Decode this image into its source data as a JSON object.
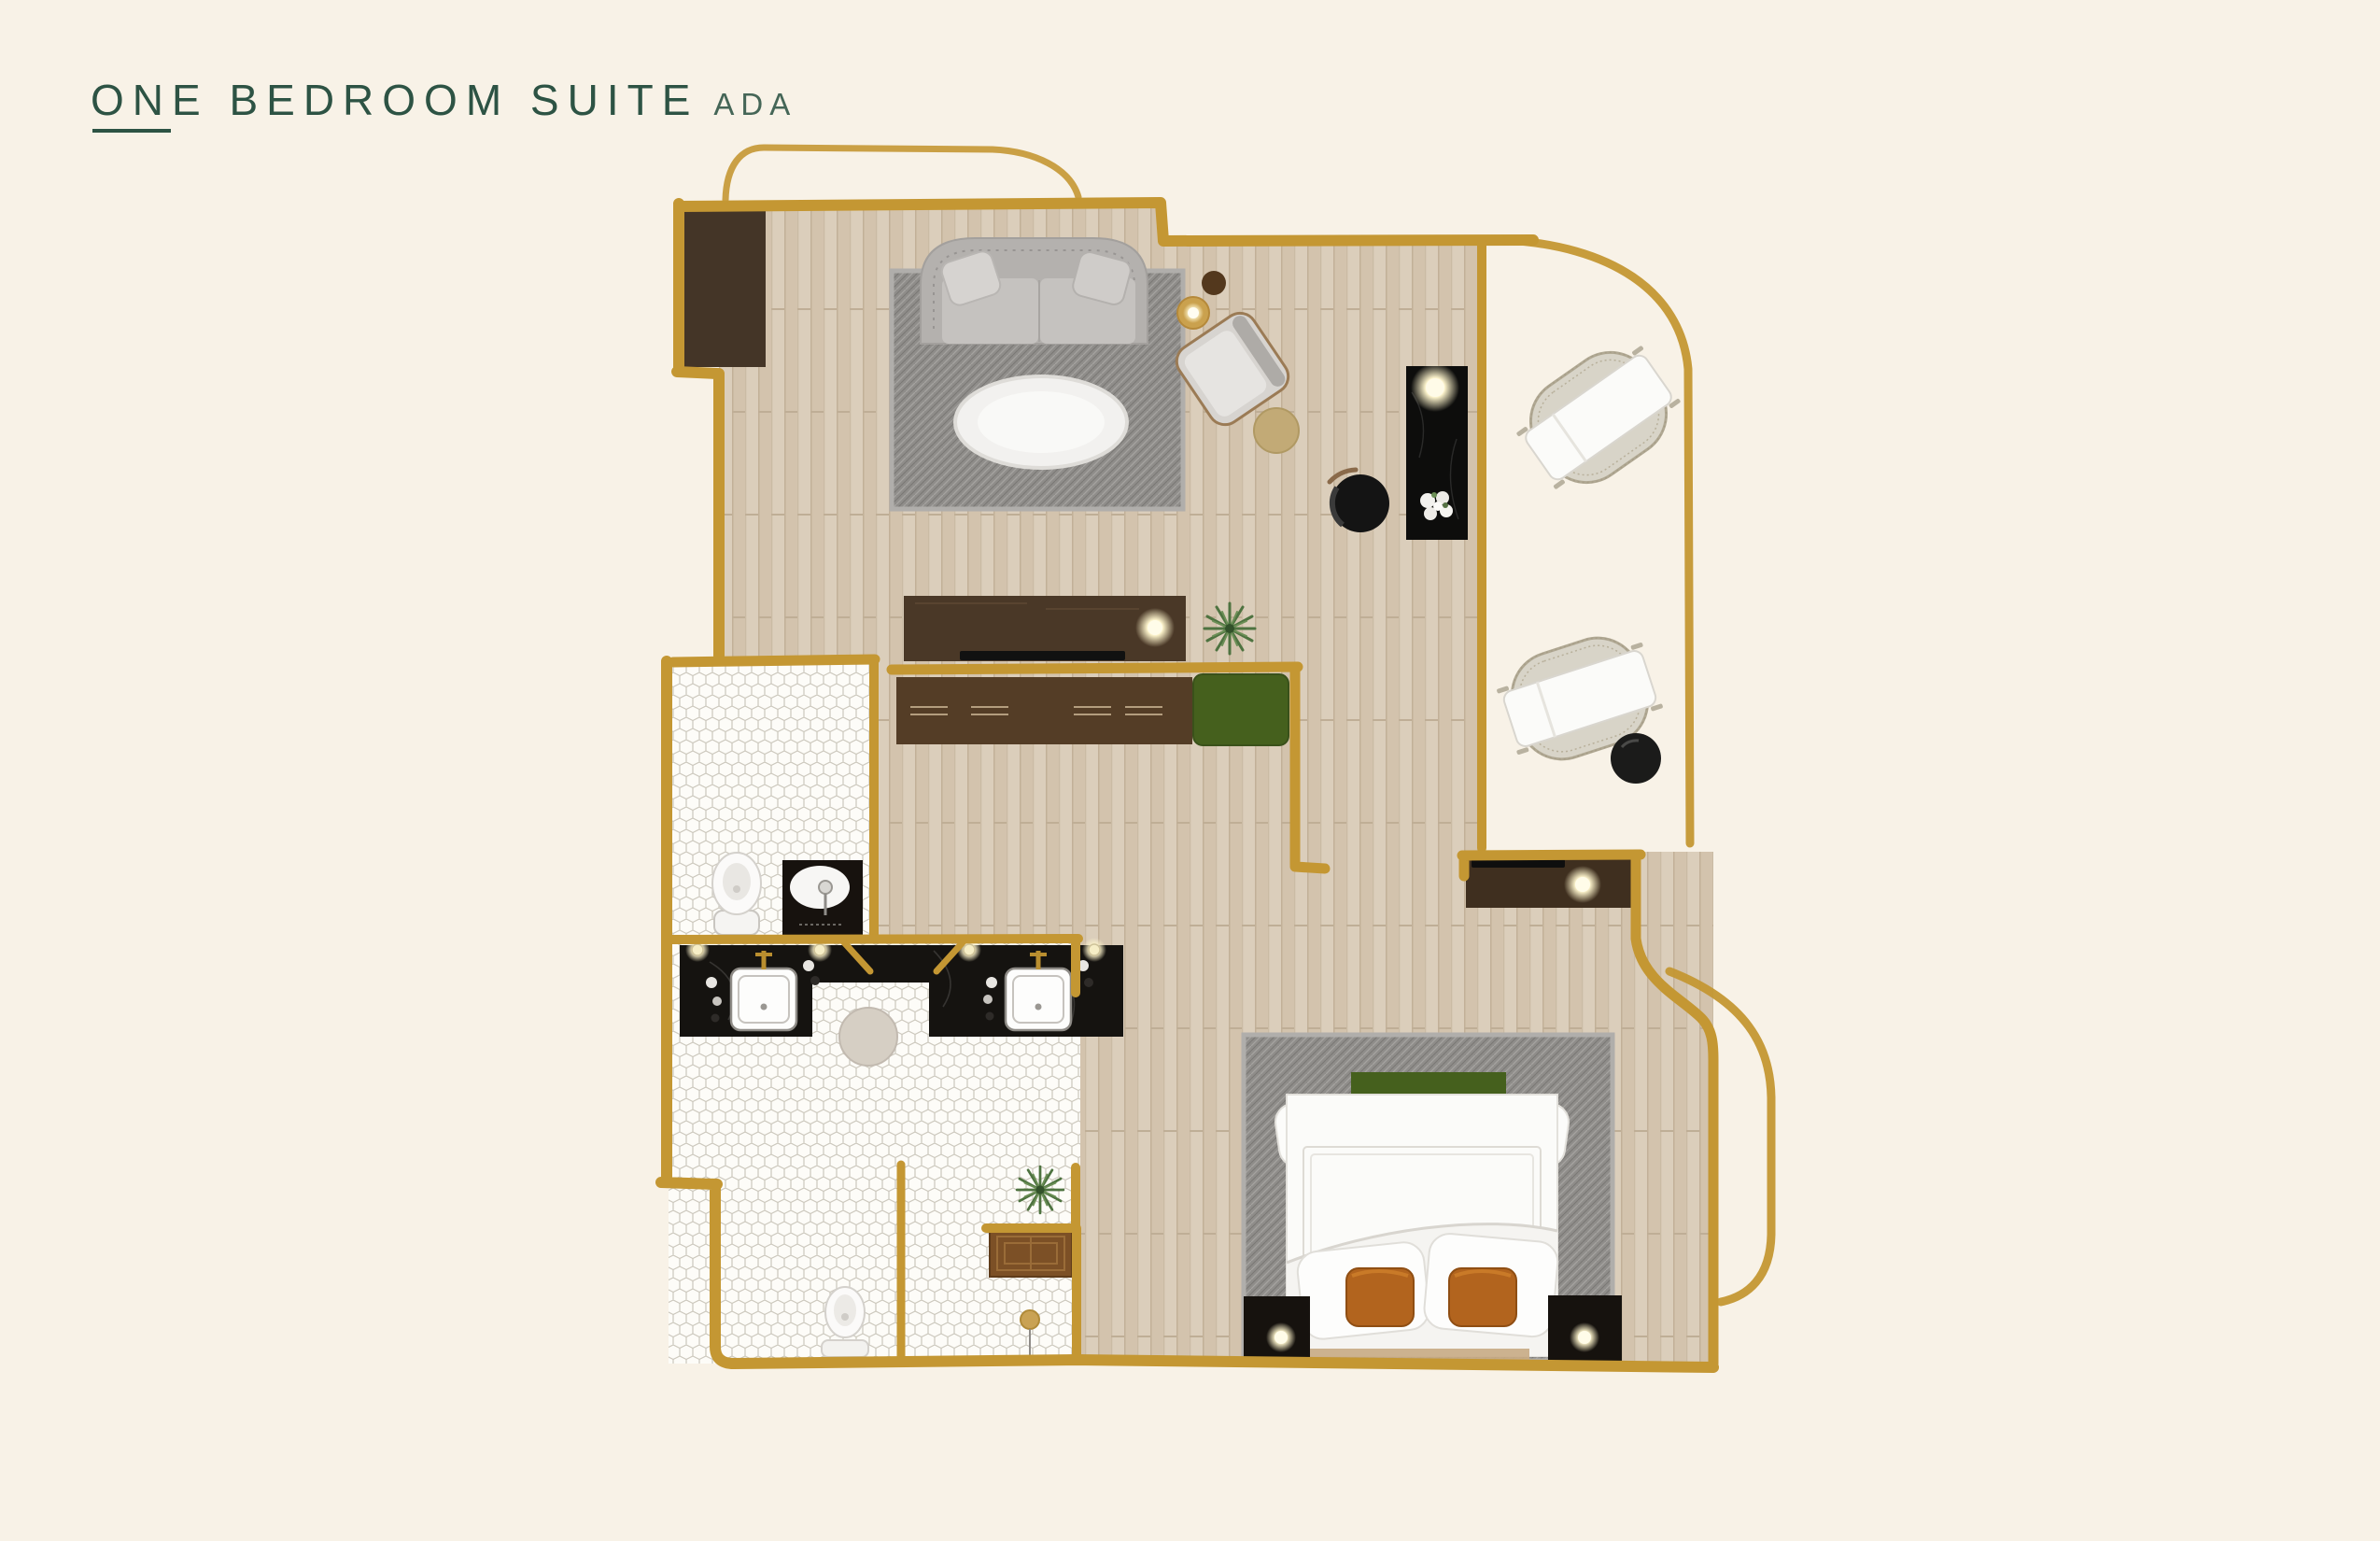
{
  "header": {
    "title": "ONE BEDROOM SUITE",
    "badge": "ADA"
  },
  "palette": {
    "background": "#f8f2e7",
    "title-green": "#2d5344",
    "wall-gold": "#c49733",
    "wood": "#dbcebb",
    "wood-line": "#c2b098",
    "dark-wood": "#443527",
    "walnut": "#543d26",
    "rug-gray": "#8f8d8a",
    "sofa-gray": "#b4b1ae",
    "accent-green": "#45601d",
    "pillow-orange": "#b2641e",
    "black-furniture": "#141414",
    "lamp-glow": "#fcf3cb",
    "hex-tile-line": "#cbc7bc",
    "wicker": "#d8d4c8",
    "teak-bench": "#7c5026",
    "vanity-stone": "#151310",
    "stool-stone": "#d6cfc4"
  }
}
